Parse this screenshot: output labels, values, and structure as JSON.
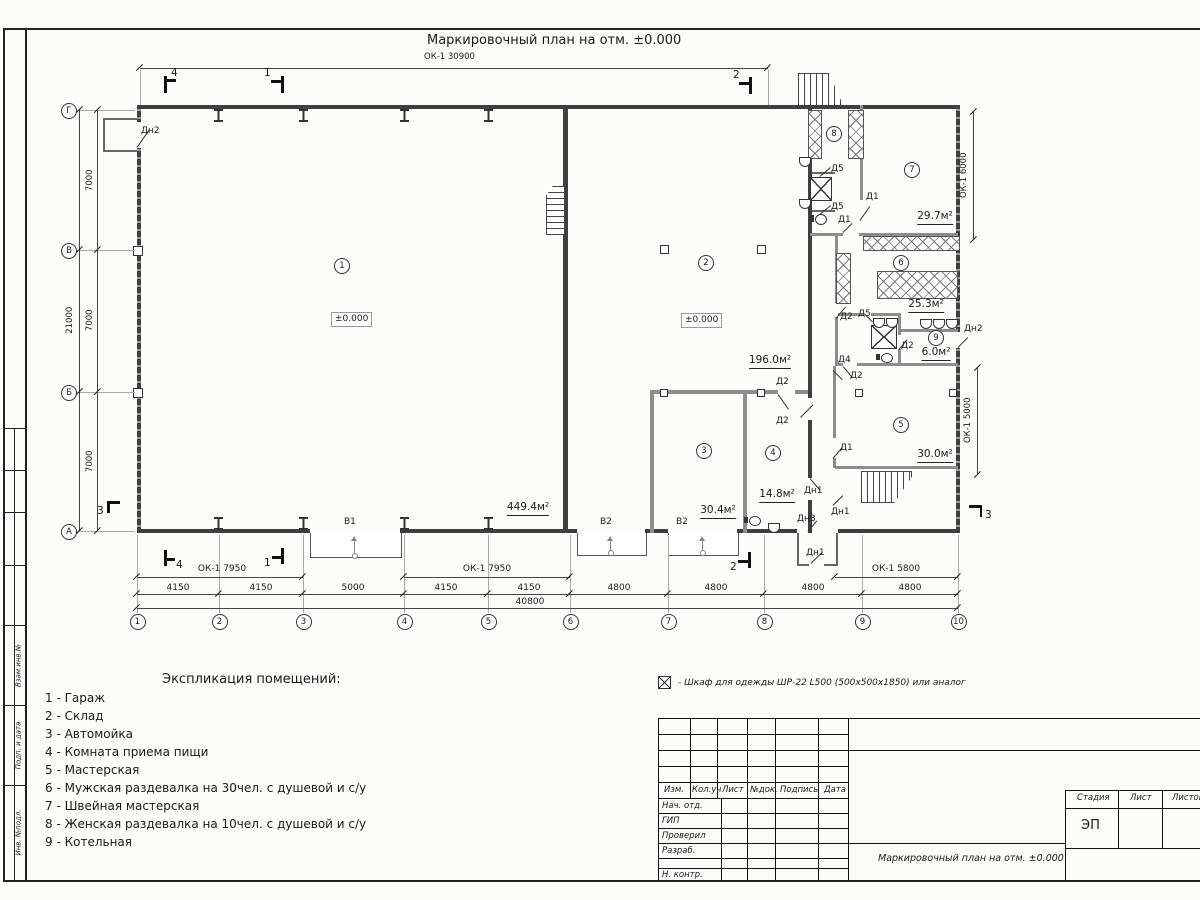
{
  "sheet": {
    "title": "Маркировочный план на отм. ±0.000",
    "top_dim": "ОК-1 30900"
  },
  "labels": {
    "d1": "Д1",
    "d2": "Д2",
    "d4": "Д4",
    "d5": "Д5",
    "dn1": "Дн1",
    "dn2": "Дн2",
    "dn3": "Дн3",
    "v1": "В1",
    "v2": "В2",
    "level": "±0.000"
  },
  "rooms": {
    "r1": {
      "num": "1",
      "area": "449.4м²"
    },
    "r2": {
      "num": "2",
      "area": "196.0м²"
    },
    "r3": {
      "num": "3",
      "area": "30.4м²"
    },
    "r4": {
      "num": "4",
      "area": "14.8м²"
    },
    "r5": {
      "num": "5",
      "area": "30.0м²"
    },
    "r6": {
      "num": "6",
      "area": "25.3м²"
    },
    "r7": {
      "num": "7",
      "area": "29.7м²"
    },
    "r8": {
      "num": "8"
    },
    "r9": {
      "num": "9",
      "area": "6.0м²"
    }
  },
  "grid": {
    "cols": [
      "1",
      "2",
      "3",
      "4",
      "5",
      "6",
      "7",
      "8",
      "9",
      "10"
    ],
    "rows": [
      "Г",
      "В",
      "Б",
      "А"
    ]
  },
  "dims": {
    "bottom": [
      "4150",
      "4150",
      "5000",
      "4150",
      "4150",
      "4800",
      "4800",
      "4800",
      "4800"
    ],
    "bottom_total": "40800",
    "left": [
      "7000",
      "7000",
      "7000"
    ],
    "left_total": "21000",
    "ok_left1": "ОК-1 7950",
    "ok_left2": "ОК-1 7950",
    "ok_right": "ОК-1 5800",
    "ok_side_top": "ОК-1 6000",
    "ok_side_bottom": "ОК-1 5000"
  },
  "sections": {
    "s1": "1",
    "s2": "2",
    "s3": "3",
    "s4": "4"
  },
  "explication": {
    "title": "Экспликация помещений:",
    "items": [
      "1 - Гараж",
      "2 - Склад",
      "3 - Автомойка",
      "4 - Комната приема пищи",
      "5 - Мастерская",
      "6 - Мужская раздевалка на 30чел. с душевой и с/у",
      "7 - Швейная мастерская",
      "8 - Женская раздевалка на 10чел. с душевой и с/у",
      "9 - Котельная"
    ]
  },
  "legend": {
    "text": "- Шкаф для одежды ШР-22 L500 (500х500х1850) или аналог"
  },
  "titleblock": {
    "rev_headers": [
      "Изм.",
      "Кол.уч",
      "Лист",
      "№док.",
      "Подпись",
      "Дата"
    ],
    "roles": [
      "Нач. отд.",
      "ГИП",
      "Проверил",
      "Разраб.",
      "",
      "Н. контр."
    ],
    "stage_label": "Стадия",
    "sheet_label": "Лист",
    "sheets_label": "Листов",
    "stage_value": "ЭП",
    "doc_title": "Маркировочный план на отм. ±0.000"
  },
  "frame_stamps": [
    "Взам.инв.№",
    "Подп. и дата",
    "Инв. №подл."
  ]
}
